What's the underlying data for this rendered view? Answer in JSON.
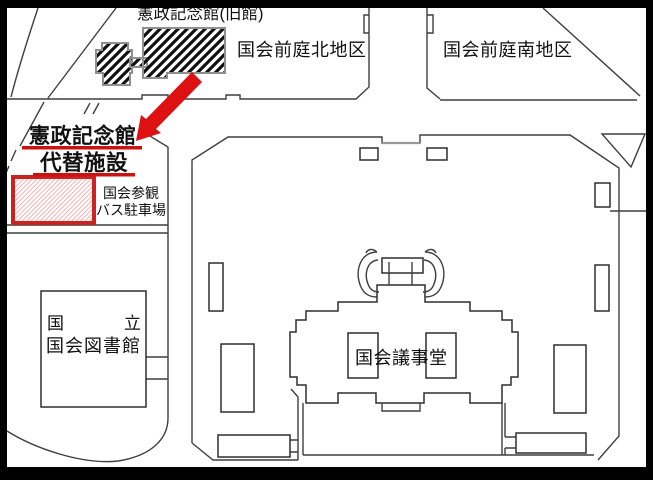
{
  "map": {
    "title_context": "National Diet area guide map",
    "labels": {
      "old_hall": "憲政記念館(旧館)",
      "north_garden": "国会前庭北地区",
      "south_garden": "国会前庭南地区",
      "facility_line1": "憲政記念館",
      "facility_line2": "代替施設",
      "bus_parking_line1": "国会参観",
      "bus_parking_line2": "バス駐車場",
      "library_line1_left": "国",
      "library_line1_right": "立",
      "library_line2": "国会図書館",
      "diet_building": "国会議事堂"
    },
    "colors": {
      "highlight_red": "#dd1111",
      "underline_red": "#cc1111",
      "site_border_red": "#cc2222",
      "site_hatch_pink": "#f0b8b8",
      "building_hatch_black": "#111111",
      "line_gray": "#3f3f3f",
      "border_black": "#000000",
      "background": "#ffffff"
    },
    "icons": {
      "arrow": "red-arrow-pointer",
      "old_hall_fill": "black-diagonal-hatch",
      "site_fill": "pink-diagonal-hatch"
    }
  }
}
